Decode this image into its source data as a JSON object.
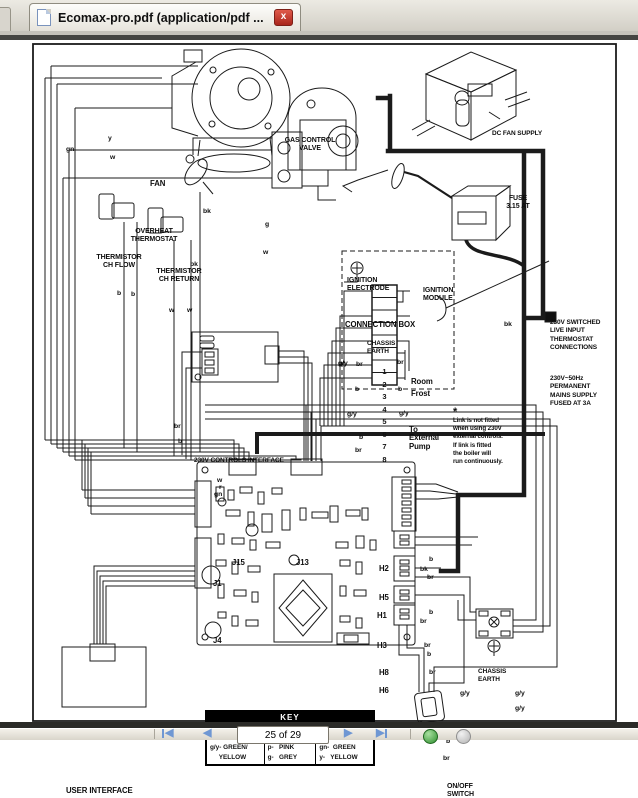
{
  "tab": {
    "title": "Ecomax-pro.pdf (application/pdf ...",
    "close_icon": "x"
  },
  "toolbar": {
    "page_field": "25 of 29",
    "prev_icon": "◀",
    "next_icon": "▶"
  },
  "diagram": {
    "fan": "FAN",
    "gas_control_valve": "GAS CONTROL\nVALVE",
    "dc_fan_supply": "DC FAN SUPPLY",
    "fuse_top": "FUSE\n3.15 AT",
    "overheat_thermostat": "OVERHEAT\nTHERMOSTAT",
    "thermistor_ch_flow": "THERMISTOR\nCH FLOW",
    "thermistor_ch_return": "THERMISTOR\nCH RETURN",
    "ignition_electrode": "IGNITION\nELECTRODE",
    "ignition_module": "IGNITION\nMODULE",
    "connection_box": "CONNECTION BOX",
    "chassis_earth_top": "CHASSIS\nEARTH",
    "room": "Room",
    "frost": "Frost",
    "external_pump": "To\nExternal\nPump",
    "asterisk": "*",
    "link_note": "Link is not fitted\nwhen using 230V\nexternal controls.\nIf link is fitted\nthe boiler will\nrun continuously.",
    "switched_live": "230V SWITCHED\nLIVE INPUT\nTHERMOSTAT\nCONNECTIONS",
    "mains_supply": "230V~50Hz\nPERMANENT\nMAINS SUPPLY\nFUSED AT 3A",
    "controls_interface": "230V CONTROLS INTERFACE",
    "control_board": "CONTROL BOARD",
    "fuse_board": "FUSE\n125mAT",
    "user_interface": "USER INTERFACE",
    "chassis_earth_bottom": "CHASSIS\nEARTH",
    "on_off_switch": "ON/OFF\nSWITCH",
    "connectors": {
      "j15": "J15",
      "j13": "J13",
      "j1": "J1",
      "j4": "J4",
      "h2": "H2",
      "h5": "H5",
      "h1": "H1",
      "h3": "H3",
      "h8": "H8",
      "h6": "H6"
    },
    "terminals": [
      "1",
      "2",
      "3",
      "4",
      "5",
      "6",
      "7",
      "8"
    ],
    "wire_labels": [
      "gn",
      "y",
      "w",
      "bk",
      "g",
      "w",
      "bk",
      "b",
      "b",
      "w",
      "w",
      "bk",
      "g/y",
      "br",
      "br",
      "b",
      "b",
      "g/y",
      "g/y",
      "b",
      "br",
      "br",
      "b",
      "w",
      "r",
      "gn",
      "b",
      "bk",
      "br",
      "b",
      "br",
      "br",
      "b",
      "br",
      "g/y",
      "g/y",
      "g/y",
      "w",
      "r",
      "b",
      "br"
    ]
  },
  "key": {
    "title": "KEY",
    "col1": "bk-  BLACK\nw-   WHITE\ng/y- GREEN/\n     YELLOW",
    "col2": "br - BROWN\nb-   BLUE\np-   PINK\ng-   GREY",
    "col3": "r -  RED\nor-  ORANGE\ngn-  GREEN\ny-   YELLOW"
  }
}
